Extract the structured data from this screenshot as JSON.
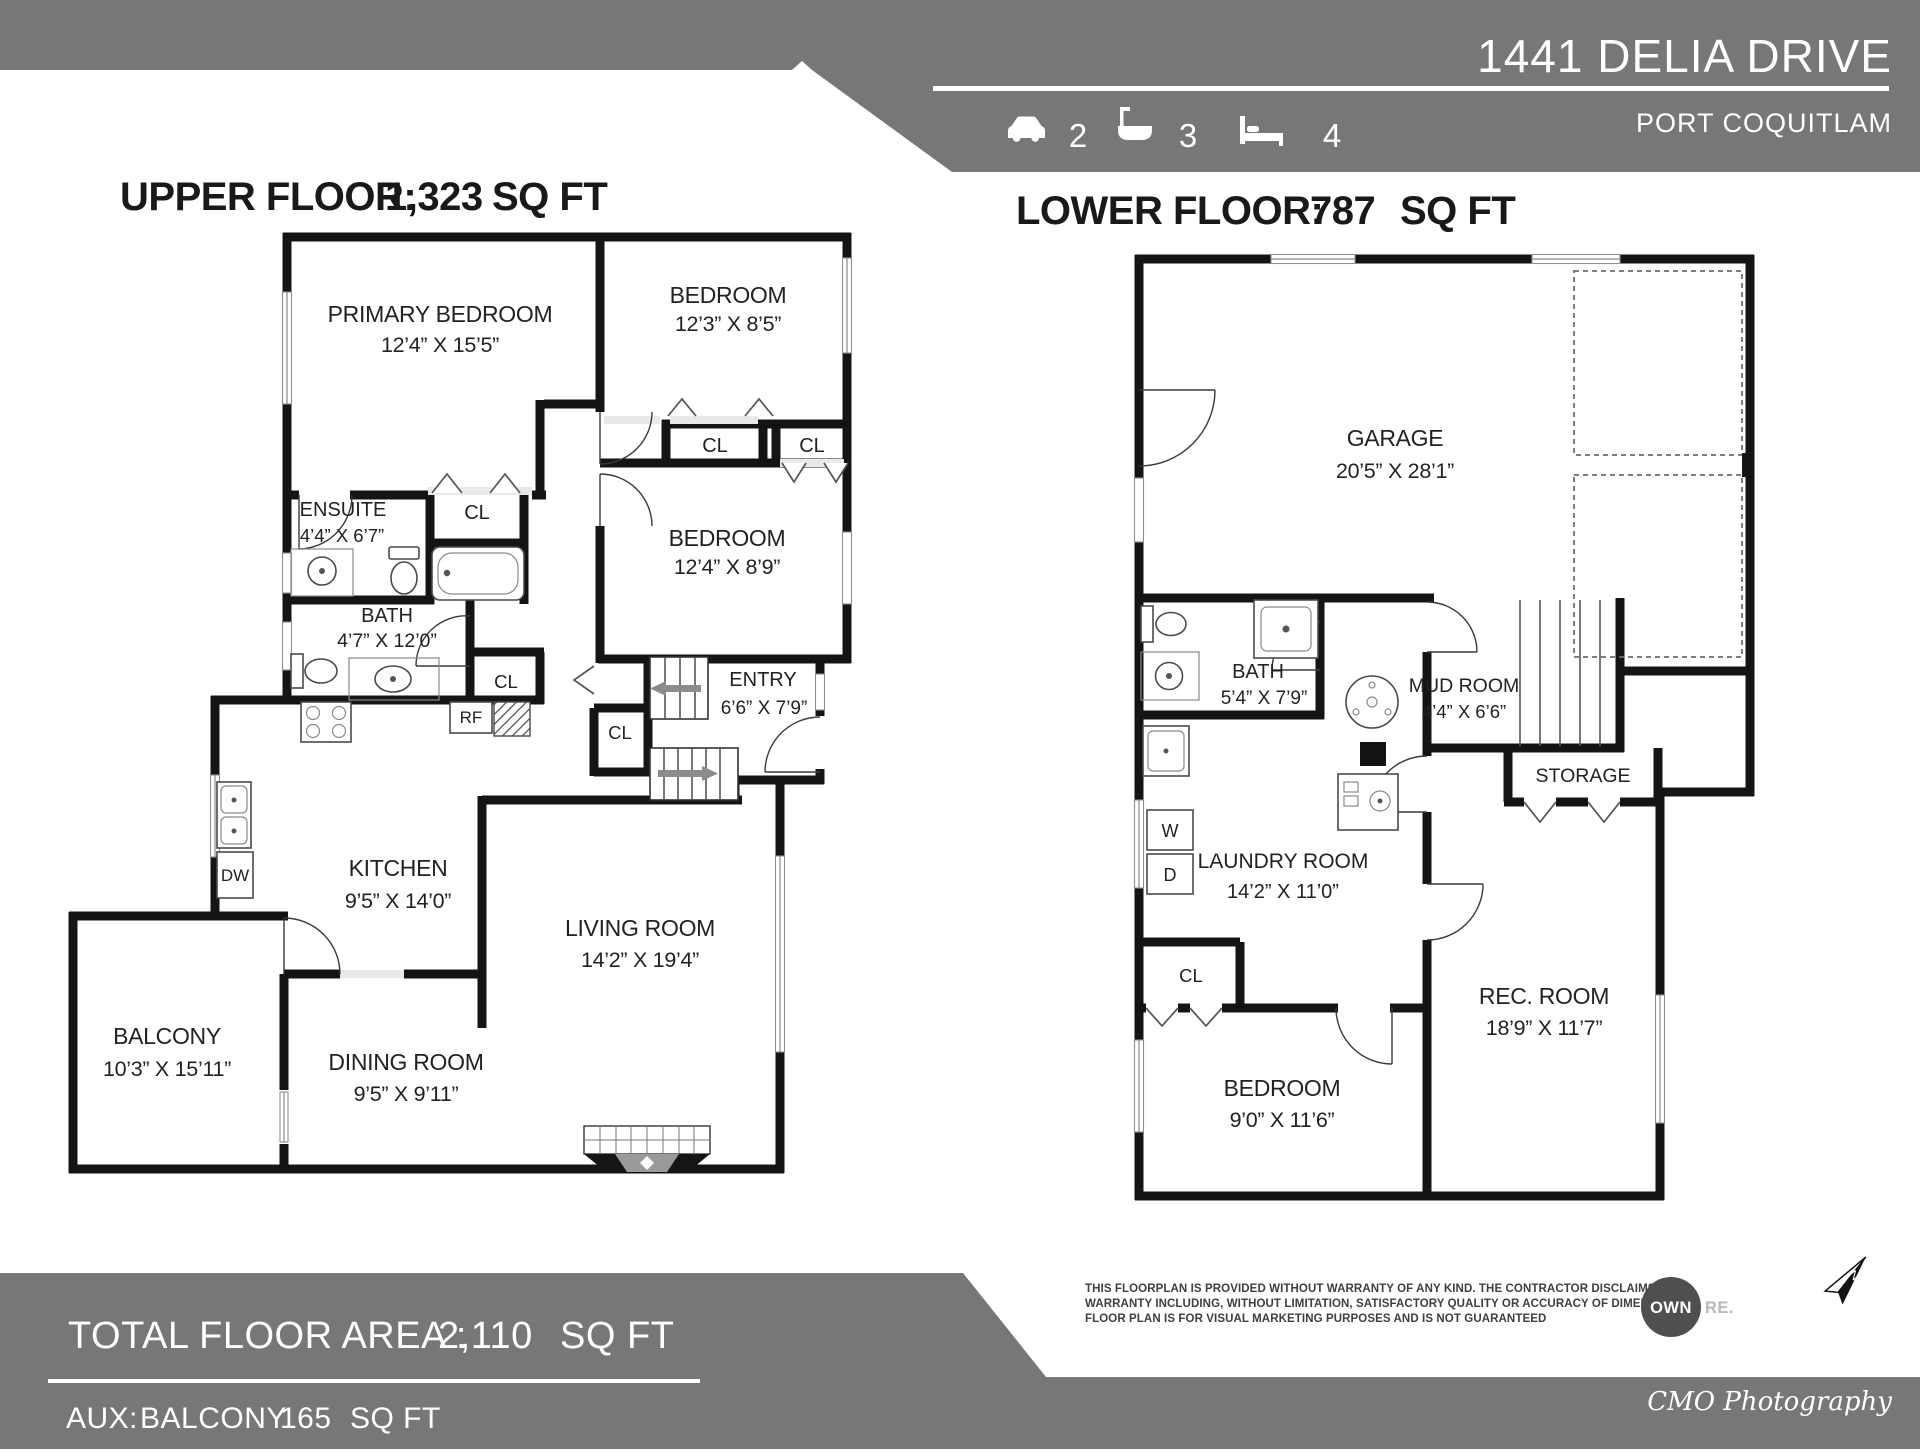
{
  "header": {
    "address": "1441 DELIA DRIVE",
    "city": "PORT COQUITLAM",
    "stats": [
      {
        "icon": "car-icon",
        "value": "2"
      },
      {
        "icon": "bath-icon",
        "value": "3"
      },
      {
        "icon": "bed-icon",
        "value": "4"
      }
    ]
  },
  "upper": {
    "title_label": "UPPER FLOOR:",
    "title_value": "1,323",
    "title_unit": "SQ FT",
    "rooms": [
      {
        "name": "PRIMARY BEDROOM",
        "dims": "12’4” X 15’5”"
      },
      {
        "name": "BEDROOM",
        "dims": "12’3” X 8’5”"
      },
      {
        "name": "BEDROOM",
        "dims": "12’4” X 8’9”"
      },
      {
        "name": "ENSUITE",
        "dims": "4’4” X 6’7”"
      },
      {
        "name": "BATH",
        "dims": "4’7” X 12’0”"
      },
      {
        "name": "ENTRY",
        "dims": "6’6” X 7’9”"
      },
      {
        "name": "KITCHEN",
        "dims": "9’5” X 14’0”"
      },
      {
        "name": "LIVING ROOM",
        "dims": "14’2” X 19’4”"
      },
      {
        "name": "DINING ROOM",
        "dims": "9’5” X 9’11”"
      },
      {
        "name": "BALCONY",
        "dims": "10’3” X 15’11”"
      }
    ],
    "closets": [
      "CL",
      "CL",
      "CL",
      "CL",
      "CL"
    ],
    "appliances": {
      "fridge": "RF",
      "dishwasher": "DW"
    }
  },
  "lower": {
    "title_label": "LOWER FLOOR:",
    "title_value": "787",
    "title_unit": "SQ FT",
    "rooms": [
      {
        "name": "GARAGE",
        "dims": "20’5” X 28’1”"
      },
      {
        "name": "BATH",
        "dims": "5’4” X 7’9”"
      },
      {
        "name": "MUD ROOM",
        "dims": "4’4” X 6’6”"
      },
      {
        "name": "STORAGE",
        "dims": ""
      },
      {
        "name": "LAUNDRY ROOM",
        "dims": "14’2” X 11’0”"
      },
      {
        "name": "BEDROOM",
        "dims": "9’0” X 11’6”"
      },
      {
        "name": "REC. ROOM",
        "dims": "18’9” X 11’7”"
      }
    ],
    "labels": {
      "washer": "W",
      "dryer": "D",
      "closet": "CL"
    }
  },
  "footer": {
    "total_label": "TOTAL FLOOR AREA :",
    "total_value": "2,110",
    "total_unit": "SQ FT",
    "aux_label": "AUX:",
    "aux_name": "BALCONY",
    "aux_value": "165",
    "aux_unit": "SQ FT",
    "disclaimer": [
      "THIS FLOORPLAN IS PROVIDED WITHOUT WARRANTY OF ANY KIND.  THE CONTRACTOR DISCLAIMS ANY",
      "WARRANTY INCLUDING, WITHOUT LIMITATION, SATISFACTORY QUALITY OR ACCURACY OF DIMENSIONS.",
      "FLOOR PLAN IS FOR VISUAL MARKETING PURPOSES AND IS NOT GUARANTEED"
    ],
    "logo_own": "OWN",
    "logo_re": "RE.",
    "compass_label": "N",
    "credit": "CMO Photography"
  },
  "colors": {
    "banner": "#777777",
    "wall": "#141414",
    "logo_circle": "#4f4f4f"
  }
}
